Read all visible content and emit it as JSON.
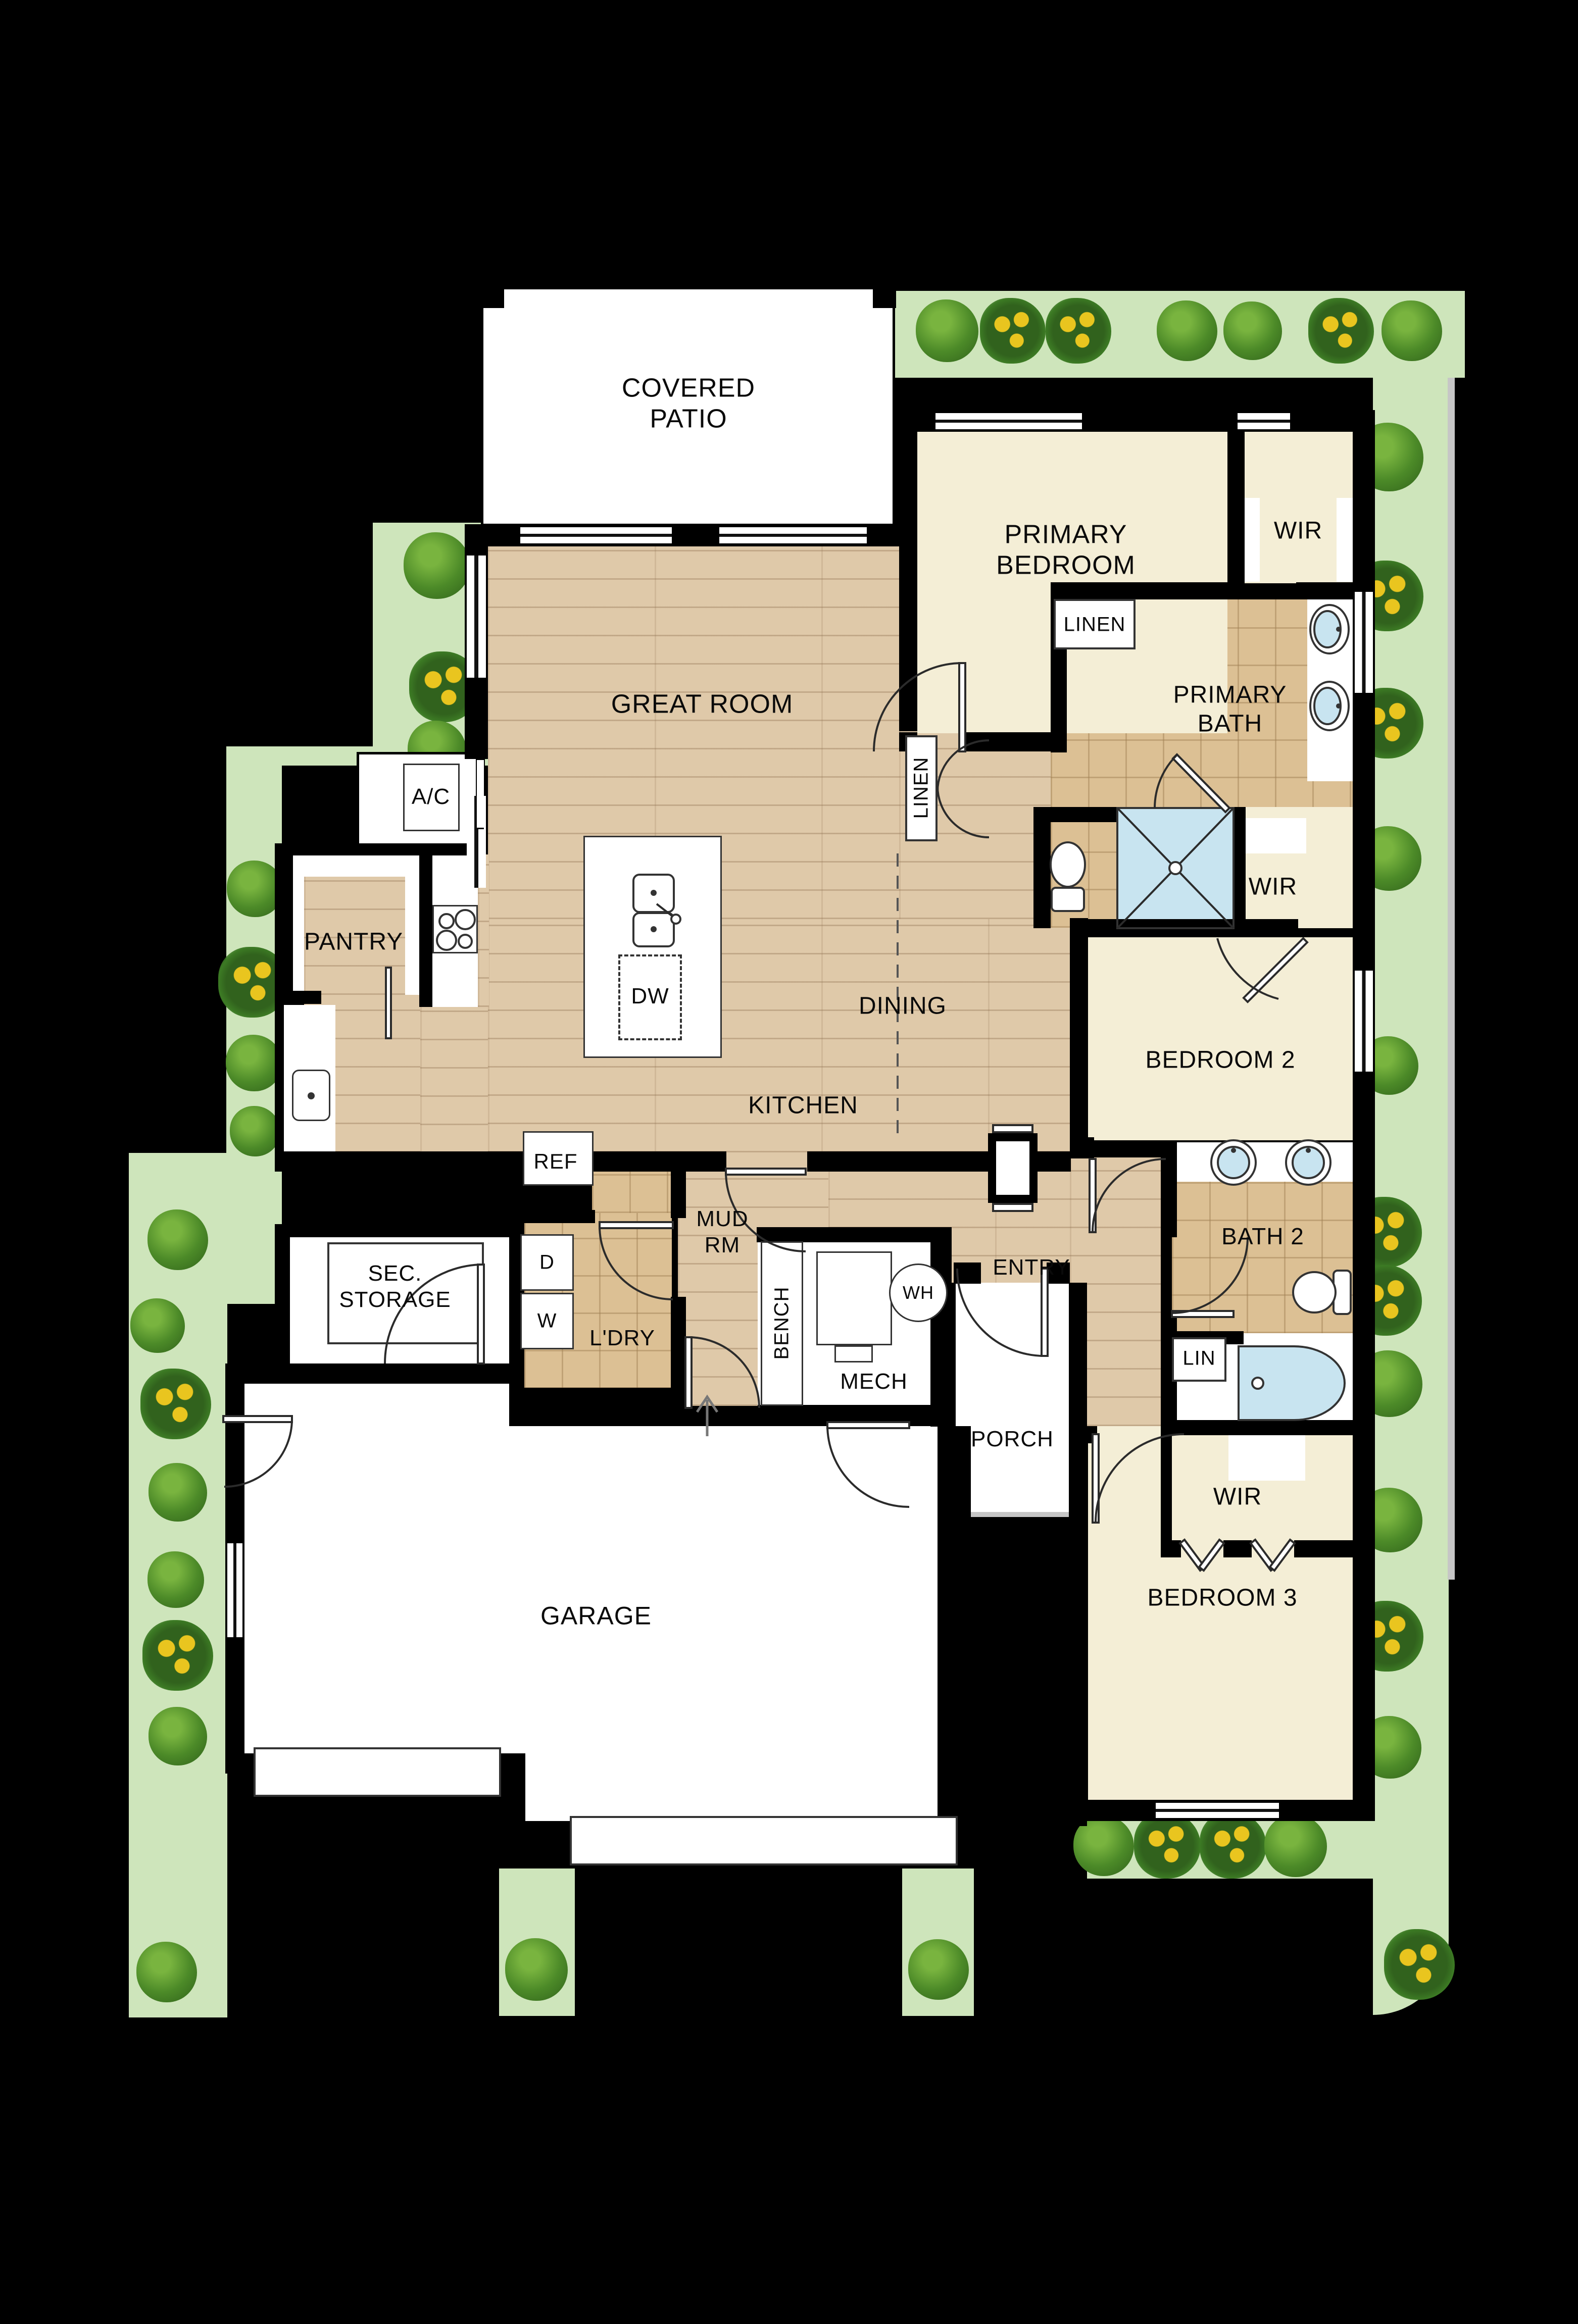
{
  "title": "Single-story floor plan",
  "labels": {
    "covered_patio": "COVERED PATIO",
    "primary_bedroom": "PRIMARY BEDROOM",
    "wir1": "WIR",
    "wir2": "WIR",
    "wir3": "WIR",
    "great_room": "GREAT ROOM",
    "linen_hall": "LINEN",
    "linen_bath": "LINEN",
    "primary_bath": "PRIMARY BATH",
    "ac": "A/C",
    "pantry": "PANTRY",
    "dining": "DINING",
    "bedroom2": "BEDROOM 2",
    "kitchen": "KITCHEN",
    "dw": "DW",
    "ref": "REF",
    "mud_rm": "MUD RM",
    "entry": "ENTRY",
    "bath2": "BATH 2",
    "sec_storage": "SEC. STORAGE",
    "ldry": "L'DRY",
    "dryer": "D",
    "washer": "W",
    "bench": "BENCH",
    "mech": "MECH",
    "wh": "WH",
    "lin": "LIN",
    "porch": "PORCH",
    "garage": "GARAGE",
    "bedroom3": "BEDROOM 3"
  },
  "colors": {
    "bg": "#000000",
    "landscape": "#cee5bb",
    "wood": "#dfc9a9",
    "tile": "#dcc094",
    "cream": "#f4eed6",
    "water": "#c8e4f0",
    "wall": "#000000",
    "white": "#ffffff"
  }
}
